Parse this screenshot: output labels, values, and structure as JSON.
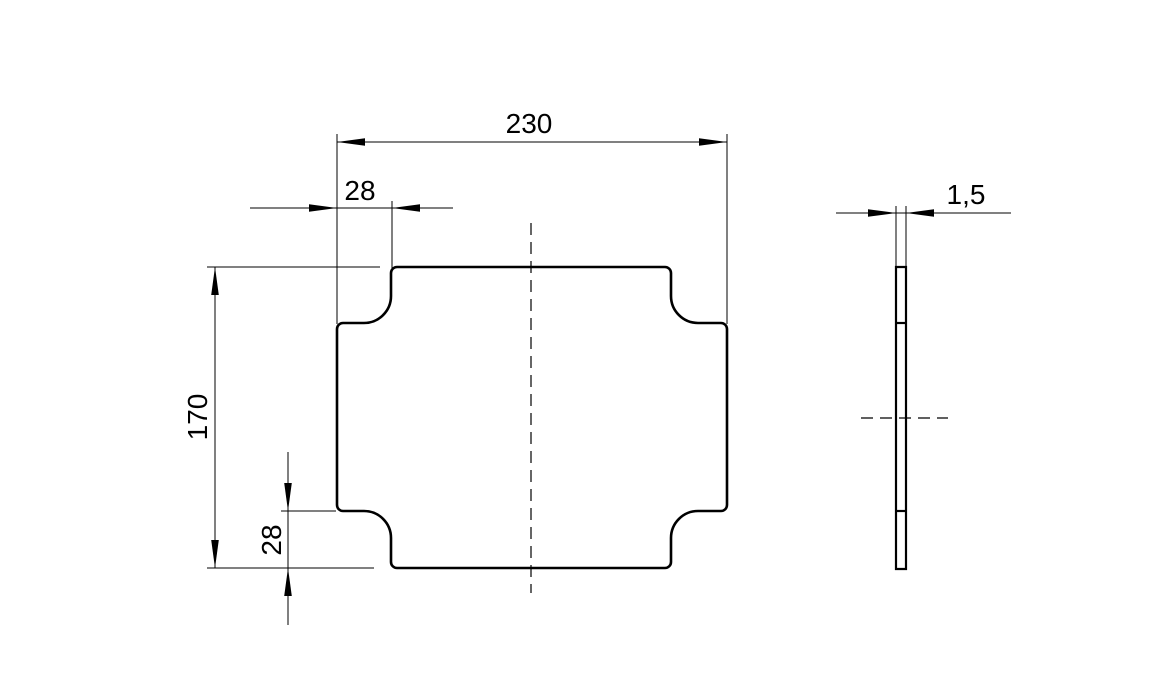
{
  "colors": {
    "line": "#000000",
    "background": "#ffffff"
  },
  "front_view": {
    "dimensions": {
      "overall_width": "230",
      "notch_width": "28",
      "overall_height": "170",
      "notch_height": "28"
    }
  },
  "side_view": {
    "dimensions": {
      "thickness": "1,5"
    }
  }
}
